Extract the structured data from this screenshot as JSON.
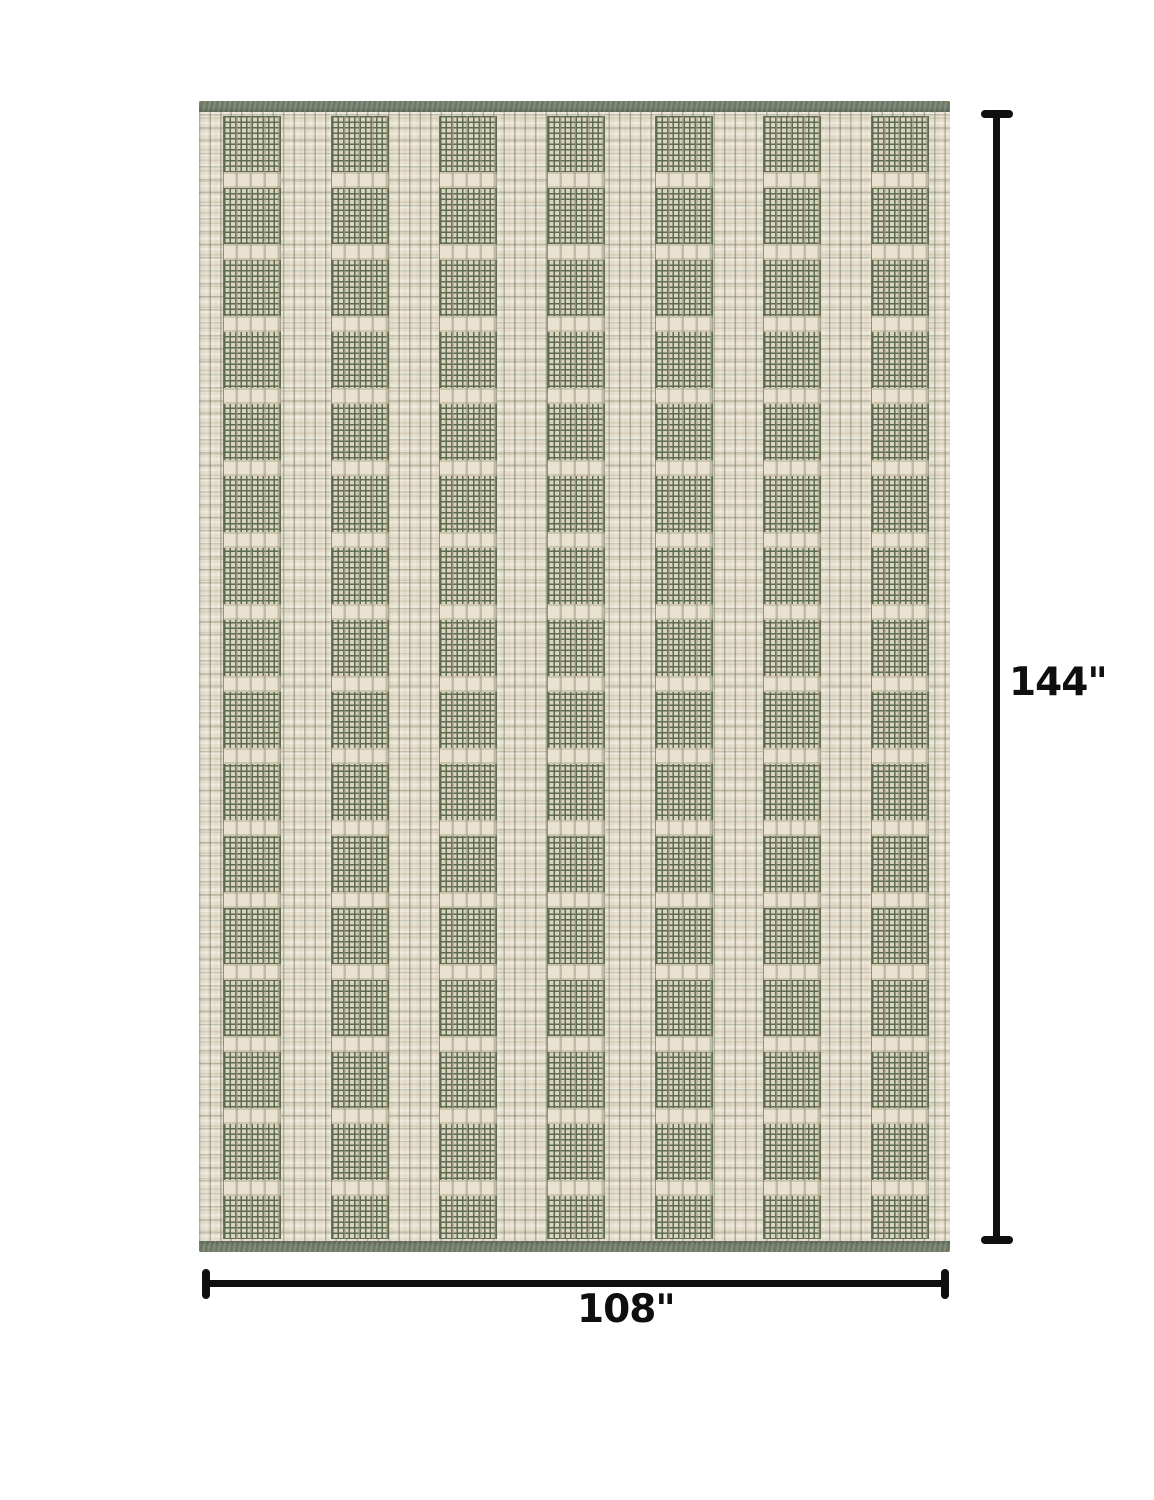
{
  "image": {
    "background_color": "#ffffff",
    "annotation_color": "#0f0f0f"
  },
  "dimensions": {
    "height_label": "144\"",
    "width_label": "108\""
  },
  "rug": {
    "colors": {
      "ivory_field": "#e3dbc8",
      "ivory_knot": "#e9e2d0",
      "ivory_edge": "#cfc6ae",
      "mesh_base": "#dbd4bf",
      "mesh_line": "#5c6a50",
      "edge_band": "#6e7966"
    },
    "pattern": {
      "green_column_count": 7,
      "first_column_left_px": 24,
      "column_pitch_px": 108,
      "column_width_px": 56,
      "green_block_height_px": 56,
      "ivory_row_height_px": 16,
      "edge_band_height_px": 11
    }
  }
}
